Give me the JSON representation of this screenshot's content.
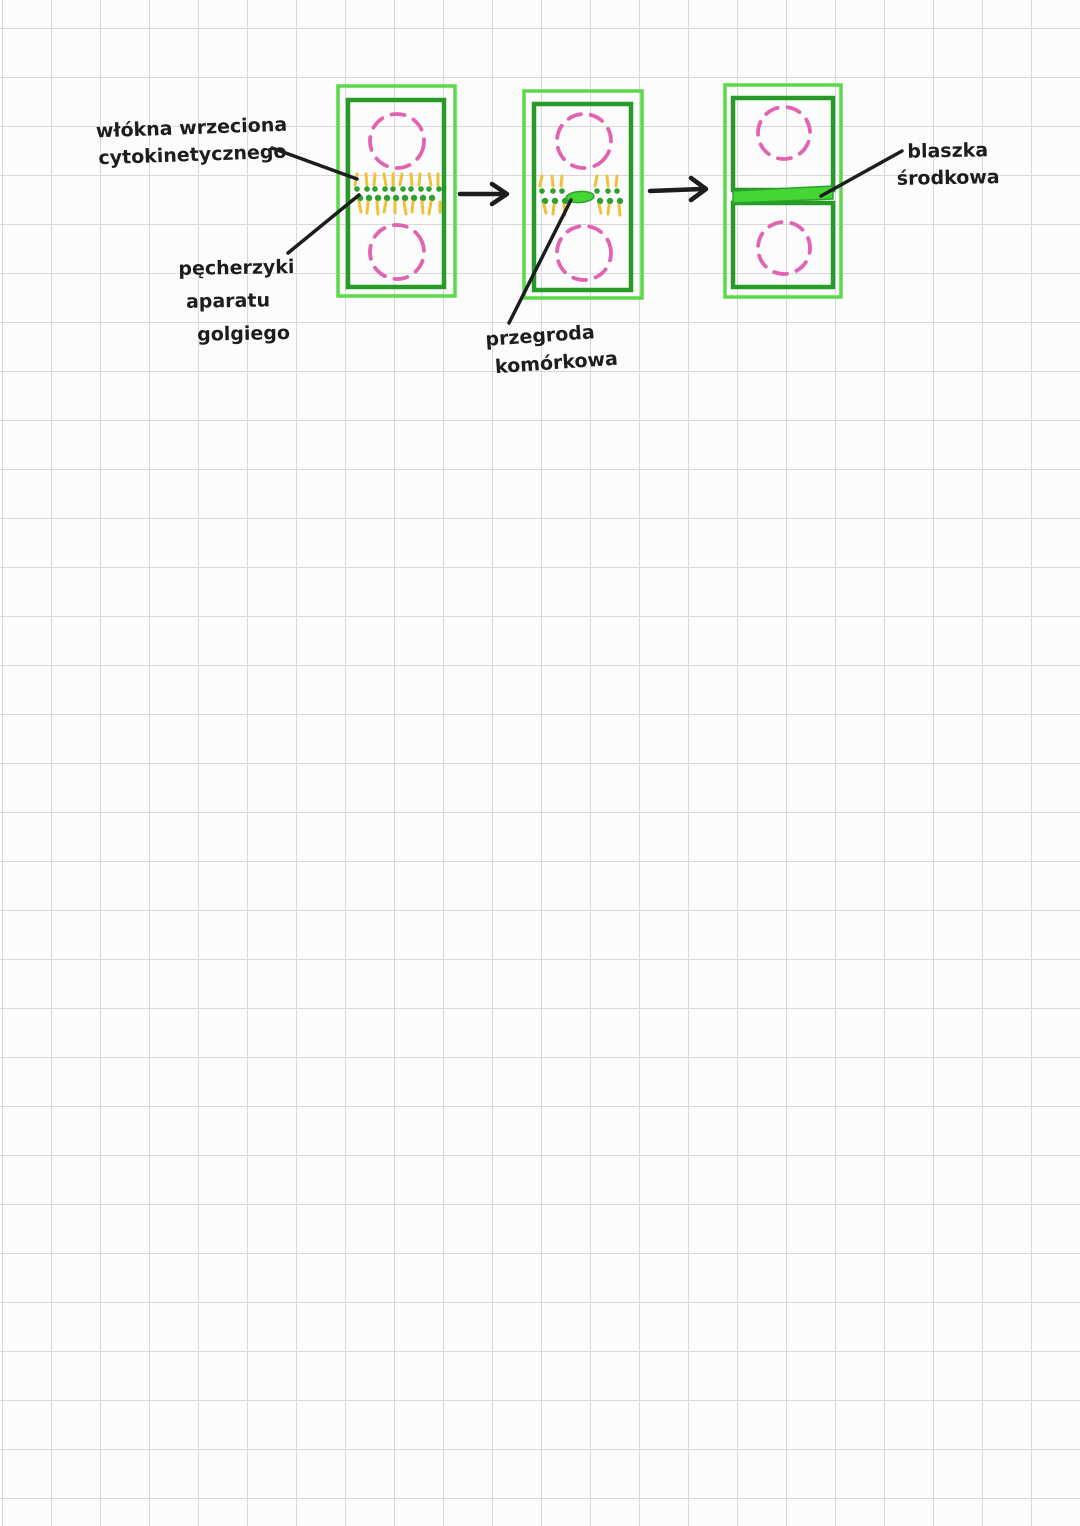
{
  "page": {
    "type": "notebook-grid-paper",
    "background": "#fcfcfc",
    "grid_color": "#d8d8da",
    "grid_size_px": 49
  },
  "colors": {
    "cell_wall_outer_green": "#5bda49",
    "cell_wall_inner_green": "#279a27",
    "nucleus_dashed_pink": "#e263b1",
    "spindle_fiber_yellow": "#eec137",
    "vesicle_dot_green": "#2f9f2e",
    "cell_plate_green": "#43d634",
    "ink_black": "#1d1d1f"
  },
  "diagram": {
    "stage_count": 3,
    "labels": {
      "spindle_fibers": {
        "line1": "włókna wrzeciona",
        "line2": "cytokinetycznego"
      },
      "golgi_vesicles": {
        "line1": "pęcherzyki",
        "line2": "aparatu",
        "line3": "golgiego"
      },
      "cell_plate": {
        "line1": "przegroda",
        "line2": "komórkowa"
      },
      "middle_lamella": {
        "line1": "blaszka",
        "line2": "środkowa"
      }
    }
  }
}
